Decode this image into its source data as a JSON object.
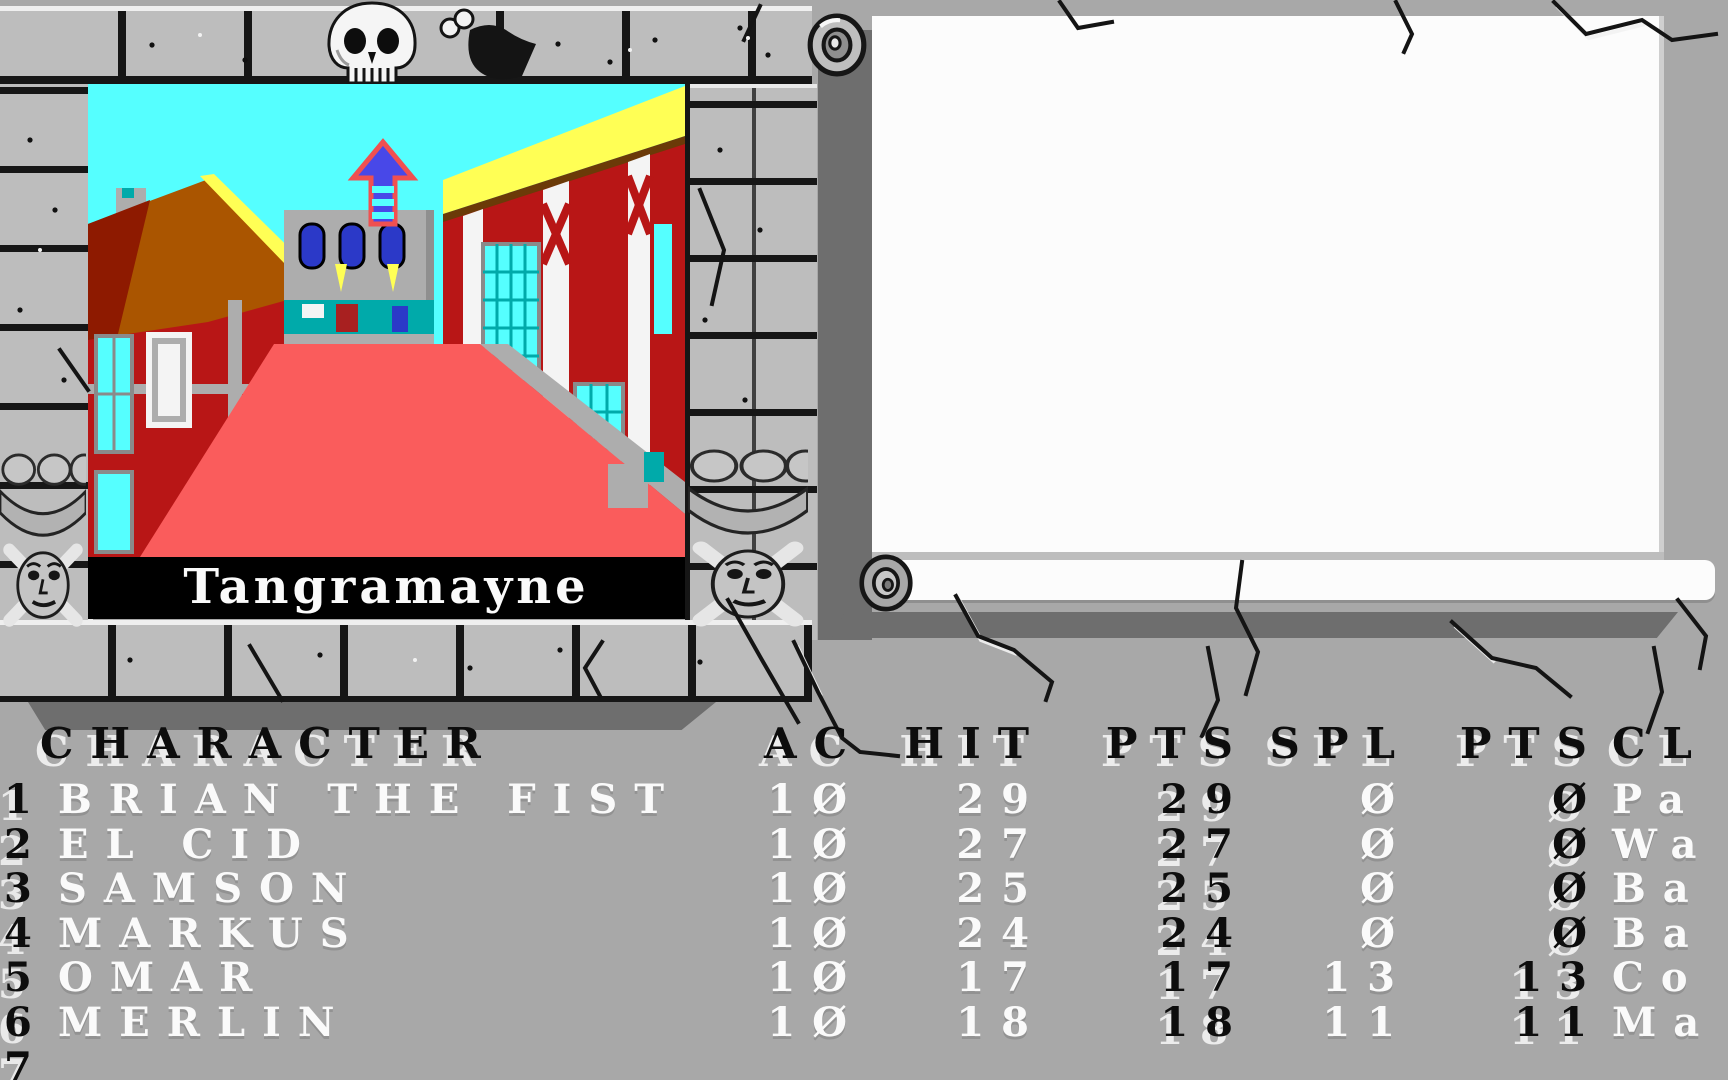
{
  "palette": {
    "bg": "#A8A8A8",
    "brick": "#BDBDBD",
    "shadow": "#6E6E6E",
    "sky": "#55FFFF",
    "street": "#FA5C5C",
    "roof": "#AA5500",
    "roofdark": "#8E1A00",
    "red": "#B81616",
    "red2": "#B83333",
    "yellow": "#FFFF55",
    "teal": "#00AAAA",
    "cyan": "#55FFFF",
    "blue": "#2B39C8",
    "gray": "#ADADAD",
    "white": "#F4F4F4",
    "parchment": "#FCFCFC",
    "textwhite": "#FAFAFA",
    "textblack": "#0D0D0D"
  },
  "viewport": {
    "location_label": "Tangramayne"
  },
  "scroll_window": {
    "text": ""
  },
  "icons": {
    "frame_top": "skull-icon",
    "frame_corners": "skull-and-crossbones-icon",
    "direction_indicator": "arrow-up-icon",
    "scroll_ends": "scroll-curl-icon"
  },
  "party_table": {
    "headers": [
      "CHARACTER",
      "AC",
      "HIT",
      "PTS",
      "SPL",
      "PTS",
      "CL"
    ],
    "rows": [
      {
        "slot": "1",
        "name": "BRIAN THE FIST",
        "ac": "10",
        "hit": "29",
        "hit_pts": "29",
        "spl": "0",
        "spl_pts": "0",
        "cl": "Pa"
      },
      {
        "slot": "2",
        "name": "EL CID",
        "ac": "10",
        "hit": "27",
        "hit_pts": "27",
        "spl": "0",
        "spl_pts": "0",
        "cl": "Wa"
      },
      {
        "slot": "3",
        "name": "SAMSON",
        "ac": "10",
        "hit": "25",
        "hit_pts": "25",
        "spl": "0",
        "spl_pts": "0",
        "cl": "Ba"
      },
      {
        "slot": "4",
        "name": "MARKUS",
        "ac": "10",
        "hit": "24",
        "hit_pts": "24",
        "spl": "0",
        "spl_pts": "0",
        "cl": "Ba"
      },
      {
        "slot": "5",
        "name": "OMAR",
        "ac": "10",
        "hit": "17",
        "hit_pts": "17",
        "spl": "13",
        "spl_pts": "13",
        "cl": "Co"
      },
      {
        "slot": "6",
        "name": "MERLIN",
        "ac": "10",
        "hit": "18",
        "hit_pts": "18",
        "spl": "11",
        "spl_pts": "11",
        "cl": "Ma"
      },
      {
        "slot": "7",
        "name": "",
        "ac": "",
        "hit": "",
        "hit_pts": "",
        "spl": "",
        "spl_pts": "",
        "cl": ""
      }
    ]
  }
}
